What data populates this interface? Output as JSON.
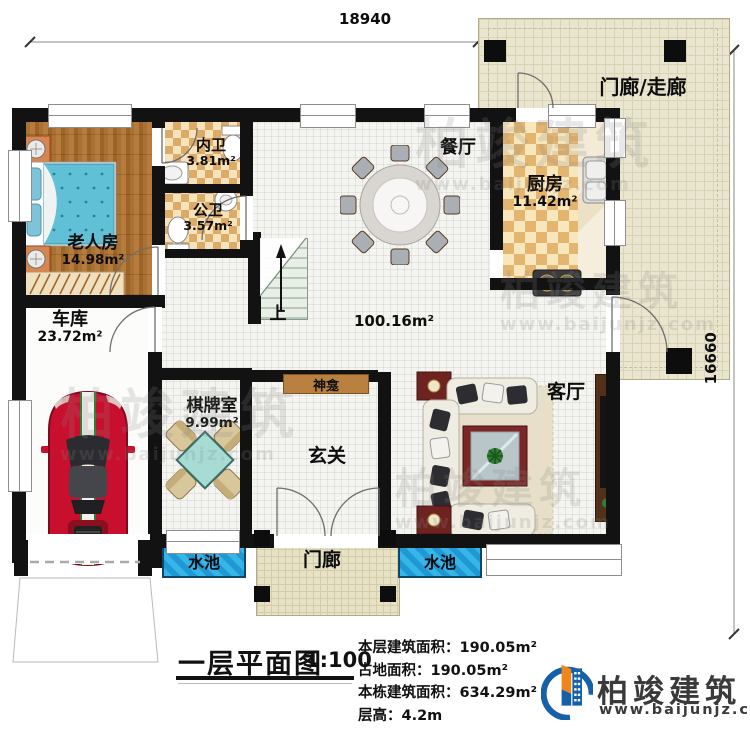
{
  "plan": {
    "dimensions": {
      "width": "18940",
      "height": "16660"
    },
    "rooms": {
      "rear_porch": {
        "label": "门廊/走廊"
      },
      "dining": {
        "label": "餐厅"
      },
      "kitchen": {
        "label": "厨房",
        "area": "11.42m²"
      },
      "inner_bath": {
        "label": "内卫",
        "area": "3.81m²"
      },
      "public_bath": {
        "label": "公卫",
        "area": "3.57m²"
      },
      "elder_room": {
        "label": "老人房",
        "area": "14.98m²"
      },
      "garage": {
        "label": "车库",
        "area": "23.72m²"
      },
      "chess_room": {
        "label": "棋牌室",
        "area": "9.99m²"
      },
      "shrine": {
        "label": "神龛"
      },
      "foyer": {
        "label": "玄关"
      },
      "living": {
        "label": "客厅"
      },
      "hall_area": {
        "area": "100.16m²"
      },
      "front_porch": {
        "label": "门廊"
      },
      "pool": {
        "label": "水池"
      },
      "stairs": {
        "label": "上"
      }
    }
  },
  "title_block": {
    "title": "一层平面图",
    "scale": "1:100"
  },
  "stats": {
    "rows": [
      {
        "label": "本层建筑面积：",
        "value": "190.05m²"
      },
      {
        "label": "占地面积：",
        "value": "190.05m²"
      },
      {
        "label": "本栋建筑面积：",
        "value": "634.29m²"
      },
      {
        "label": "层高：",
        "value": "4.2m"
      }
    ]
  },
  "brand": {
    "name": "柏竣建筑",
    "website": "www.baijunjz.com"
  },
  "watermark": {
    "name": "柏竣建筑",
    "website": "www.baijunjz.com"
  },
  "colors": {
    "wall": "#121212",
    "pool": "#2ba7dd",
    "wood_floor": "#a97434",
    "tile_checker": "#e3b56e",
    "porch_tile": "#eae5cf",
    "car": "#c8102e",
    "brand_blue": "#1660a8",
    "brand_orange": "#f08519"
  }
}
